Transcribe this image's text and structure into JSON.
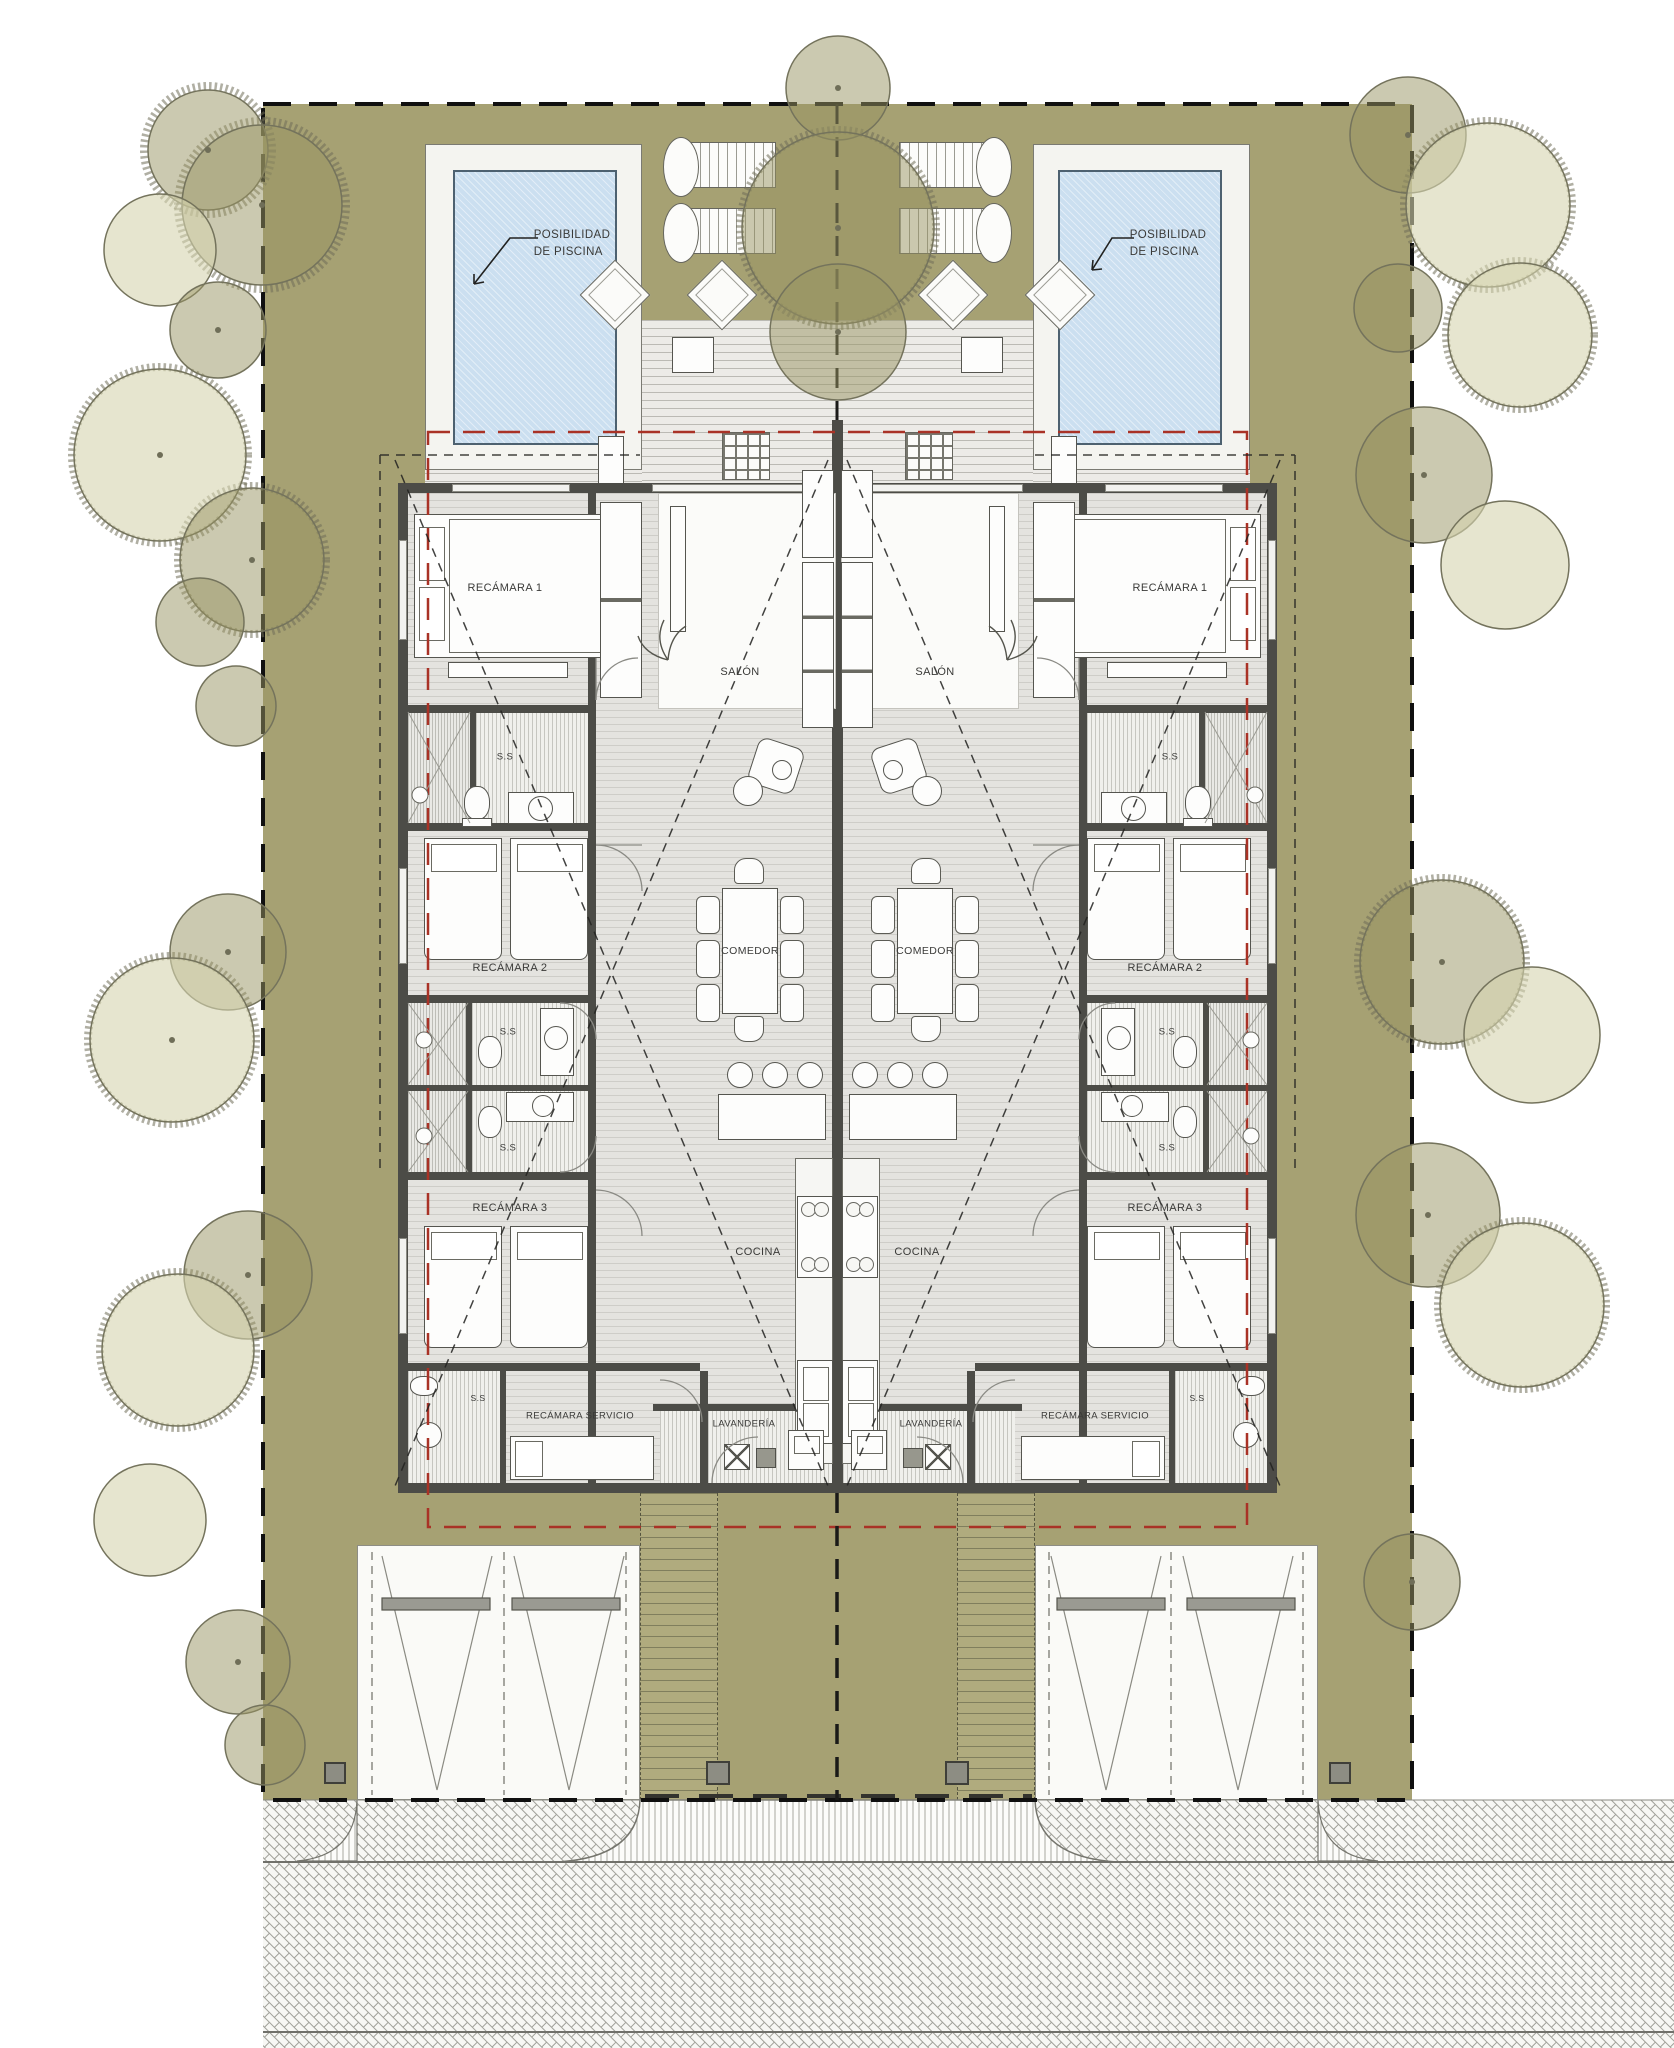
{
  "drawing": {
    "type": "architectural-site-floor-plan",
    "description": "Mirrored duplex single-storey houses with gardens, optional pools, parking and street"
  },
  "labels": {
    "recamara1": "RECÁMARA 1",
    "recamara2": "RECÁMARA 2",
    "recamara3": "RECÁMARA 3",
    "recamara_servicio": "RECÁMARA SERVICIO",
    "ss": "S.S",
    "salon": "SALÓN",
    "comedor": "COMEDOR",
    "cocina": "COCINA",
    "lavanderia": "LAVANDERÍA"
  },
  "annotations": {
    "pool_line1": "POSIBILIDAD",
    "pool_line2": "DE PISCINA"
  },
  "colors": {
    "site_green": "#a6a173",
    "pool_blue": "#cbdff0",
    "wall_dark": "#4c4c47",
    "setback_red": "#a93226",
    "boundary_black": "#101010",
    "deck_gray": "#ecebe7",
    "street_paving": "#f7f7f4"
  }
}
